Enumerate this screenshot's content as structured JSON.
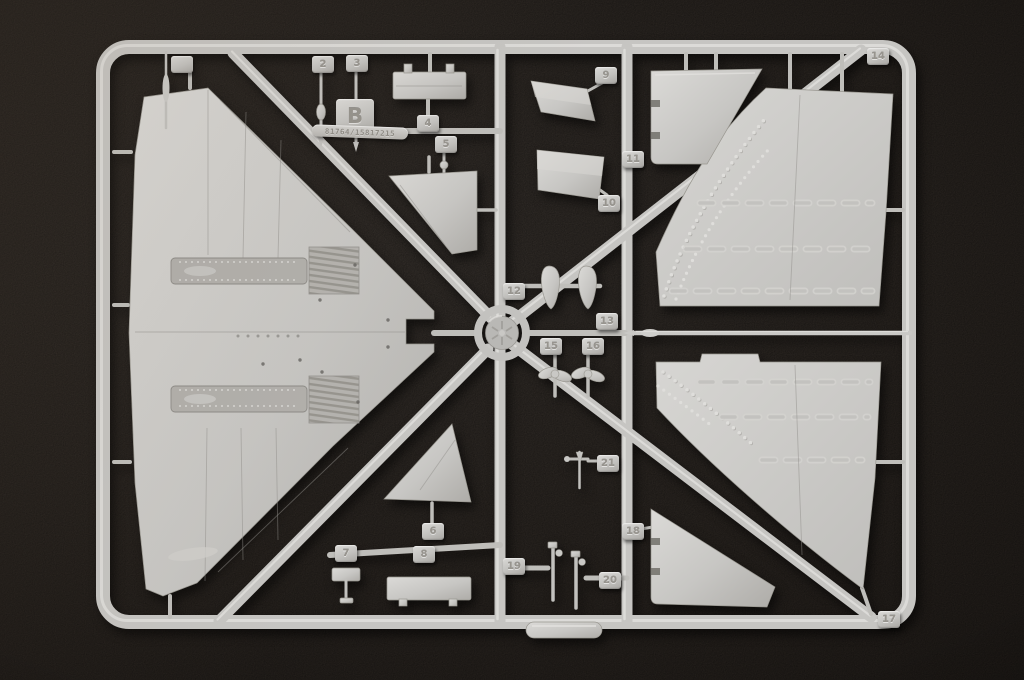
{
  "sprue": {
    "letter_tab": "B",
    "mold_code": "81764/15817215",
    "part_tabs": [
      {
        "label": ""
      },
      {
        "label": "2"
      },
      {
        "label": "3"
      },
      {
        "label": "4"
      },
      {
        "label": "5"
      },
      {
        "label": "6"
      },
      {
        "label": "7"
      },
      {
        "label": "8"
      },
      {
        "label": "9"
      },
      {
        "label": "10"
      },
      {
        "label": "11"
      },
      {
        "label": "12"
      },
      {
        "label": "13"
      },
      {
        "label": "14"
      },
      {
        "label": "15"
      },
      {
        "label": "16"
      },
      {
        "label": "17"
      },
      {
        "label": "18"
      },
      {
        "label": "19"
      },
      {
        "label": "20"
      },
      {
        "label": "21"
      }
    ],
    "colors": {
      "plastic": "#c7c6c3",
      "plastic_highlight": "#e4e3e0",
      "plastic_shadow": "#8f8d89",
      "tab_text": "#97948e",
      "background": "#322c27"
    }
  }
}
